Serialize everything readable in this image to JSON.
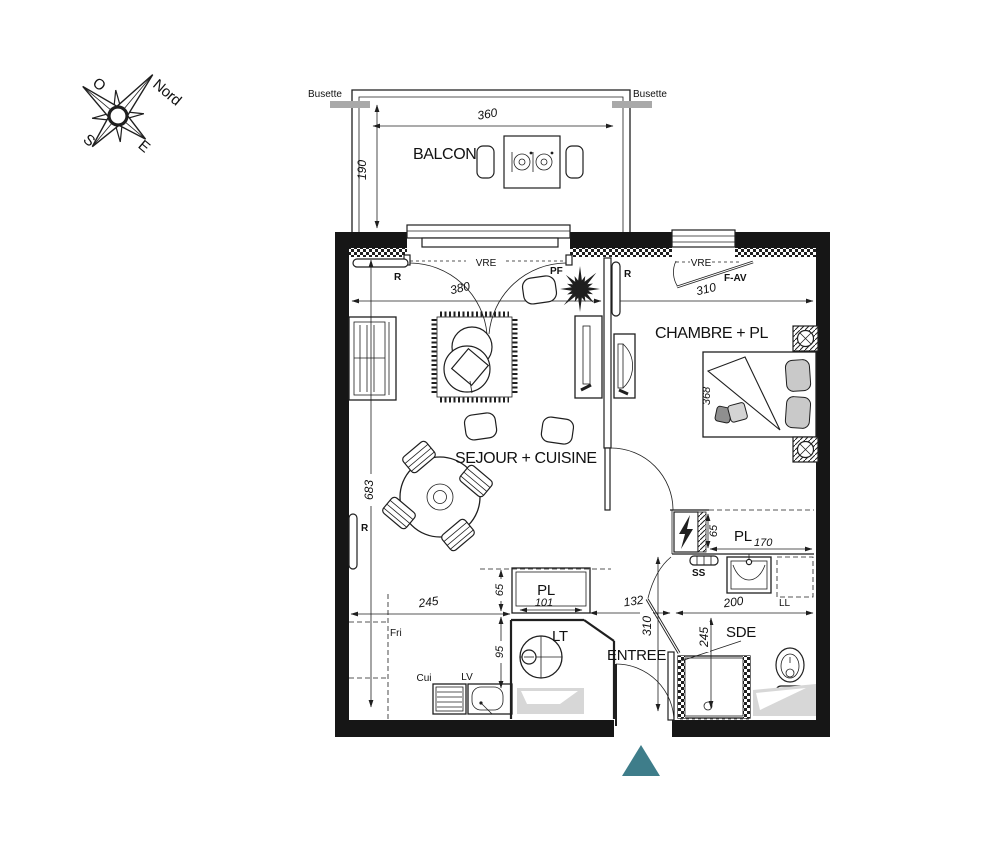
{
  "compass": {
    "north": "Nord",
    "west": "O",
    "south": "S",
    "east": "E"
  },
  "balcony": {
    "label": "BALCON",
    "busette_left": "Busette",
    "busette_right": "Busette"
  },
  "rooms": {
    "living": "SEJOUR + CUISINE",
    "bedroom": "CHAMBRE + PL",
    "entry": "ENTREE",
    "shower_room": "SDE",
    "hall_closet": "PL",
    "bedroom_closet": "PL",
    "laundry": "LT"
  },
  "dims": {
    "balcony_width": "360",
    "balcony_depth": "190",
    "living_width": "380",
    "bedroom_width": "310",
    "living_length": "683",
    "bed_length": "368",
    "kitchen_run": "245",
    "kitchen_inset": "65",
    "kitchen_depth": "95",
    "hall_closet_width": "101",
    "entry_width": "132",
    "sde_width": "200",
    "entry_depth": "310",
    "sde_depth": "245",
    "bedroom_closet_depth": "65",
    "bedroom_closet_width": "170"
  },
  "labels": {
    "vre_living": "VRE",
    "vre_bedroom": "VRE",
    "pf": "PF",
    "f_av": "F-AV",
    "radiator_top": "R",
    "radiator_bedroom": "R",
    "radiator_living": "R",
    "towel_rail": "SS",
    "washer": "LL",
    "fridge": "Fri",
    "cooker": "Cui",
    "dishwasher": "LV"
  },
  "colors": {
    "entrance_marker": "#3E7D8A"
  }
}
